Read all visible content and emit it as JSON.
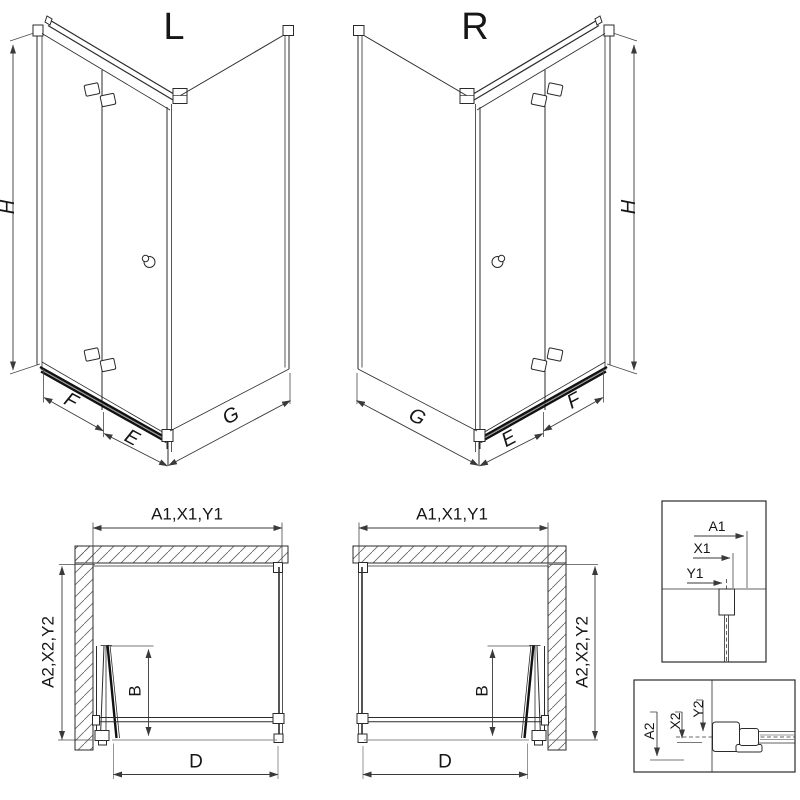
{
  "diagram": {
    "background": "#ffffff",
    "line_color": "#2b2b2b",
    "iso_left": {
      "title": "L",
      "dim_h": "H",
      "dim_f": "F",
      "dim_e": "E",
      "dim_g": "G"
    },
    "iso_right": {
      "title": "R",
      "dim_h": "H",
      "dim_f": "F",
      "dim_e": "E",
      "dim_g": "G"
    },
    "plan_left": {
      "dim_top": "A1,X1,Y1",
      "dim_side": "A2,X2,Y2",
      "dim_b": "B",
      "dim_d": "D"
    },
    "plan_right": {
      "dim_top": "A1,X1,Y1",
      "dim_side": "A2,X2,Y2",
      "dim_b": "B",
      "dim_d": "D"
    },
    "detail_top": {
      "dim_a1": "A1",
      "dim_x1": "X1",
      "dim_y1": "Y1"
    },
    "detail_bottom": {
      "dim_a2": "A2",
      "dim_x2": "X2",
      "dim_y2": "Y2"
    }
  }
}
